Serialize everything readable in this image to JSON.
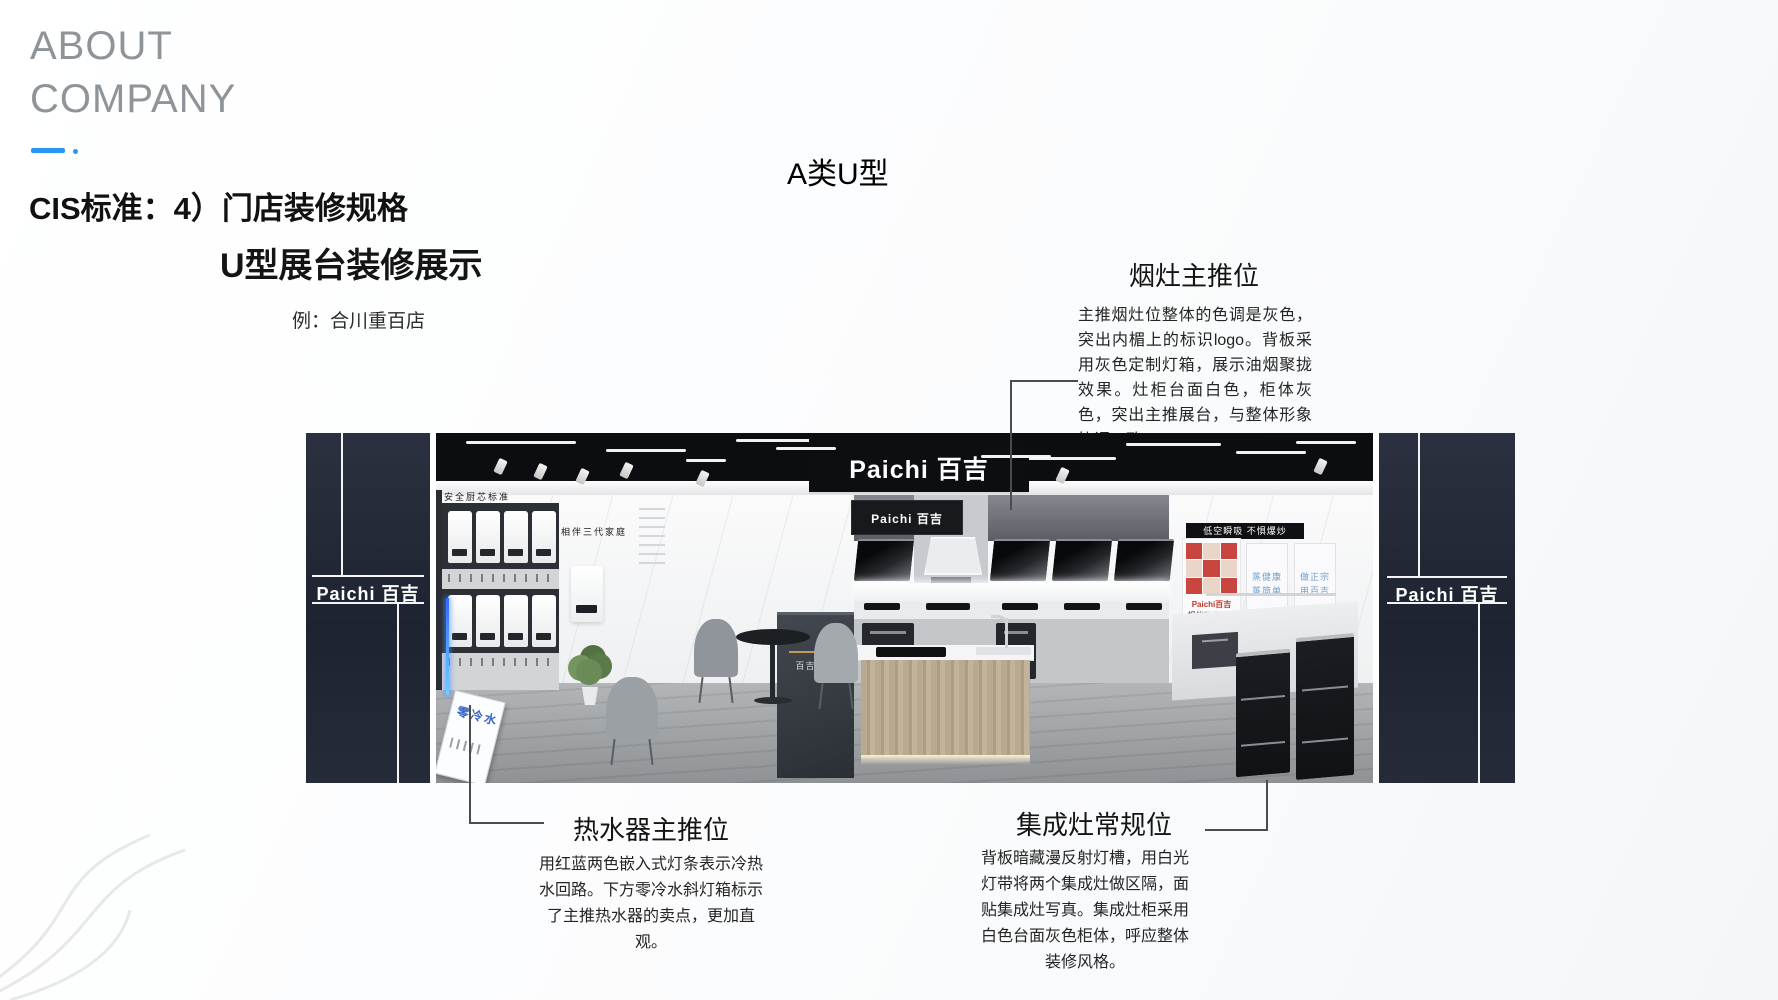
{
  "page": {
    "about_line1": "ABOUT",
    "about_line2": "COMPANY",
    "cis_title": "CIS标准：4）门店装修规格",
    "main_title": "U型展台装修展示",
    "example": "例：合川重百店",
    "variant_label": "A类U型"
  },
  "callouts": {
    "hood_stove": {
      "title": "烟灶主推位",
      "body": "主推烟灶位整体的色调是灰色，突出内楣上的标识logo。背板采用灰色定制灯箱，展示油烟聚拢效果。灶柜台面白色，柜体灰色，突出主推展台，与整体形象协调一致。"
    },
    "water_heater": {
      "title": "热水器主推位",
      "body": "用红蓝两色嵌入式灯条表示冷热水回路。下方零冷水斜灯箱标示了主推热水器的卖点，更加直观。"
    },
    "integrated_stove": {
      "title": "集成灶常规位",
      "body": "背板暗藏漫反射灯槽，用白光灯带将两个集成灶做区隔，面贴集成灶写真。集成灶柜采用白色台面灰色柜体，呼应整体装修风格。"
    }
  },
  "showroom": {
    "brand": "Paichi 百吉",
    "wall_sign_left": "安全厨芯标准",
    "wall_sign_center": "相伴三代家庭",
    "wall_sign_right": "低空瞬吸 不惧爆炒",
    "poster_brand": "Paichi百吉",
    "poster_caption": "相伴三代家庭",
    "board1": "蒸健康 蒸简单",
    "board2": "做正宗 用百吉",
    "stand_sign": "百吉电器",
    "floor_sign": "零冷水"
  },
  "colors": {
    "accent_blue": "#2797f4",
    "pillar_navy": "#242b38",
    "ceiling_black": "#0b0d10",
    "poster_red": "#c94540",
    "led_blue": "#3b7bff"
  }
}
